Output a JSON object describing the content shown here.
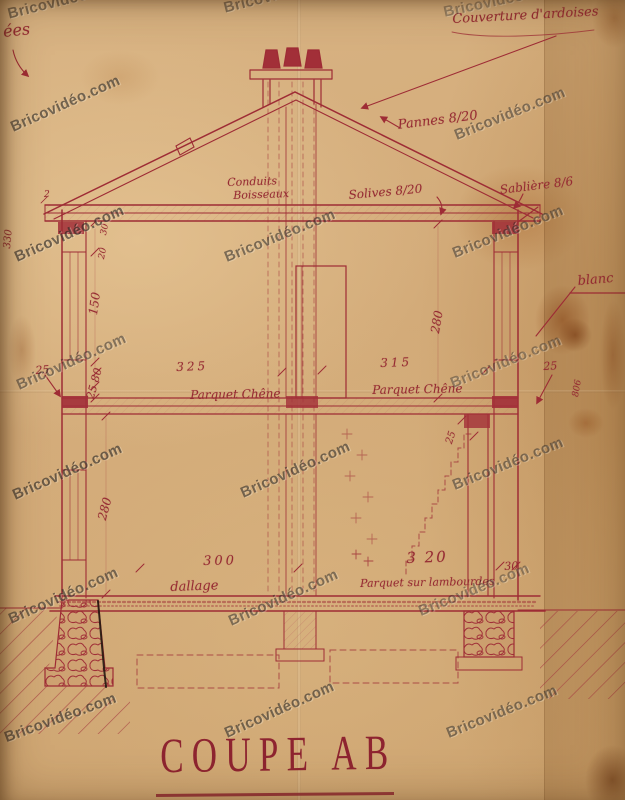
{
  "title": {
    "text": "COUPE AB"
  },
  "watermark": {
    "text": "Bricovidéo.com"
  },
  "annotations": [
    {
      "text": "ées"
    },
    {
      "text": "Couverture d'ardoises"
    },
    {
      "text": "Pannes 8/20"
    },
    {
      "text": "Conduits"
    },
    {
      "text": "Boisseaux"
    },
    {
      "text": "Solives 8/20"
    },
    {
      "text": "Sablière 8/6"
    },
    {
      "text": "blanc"
    },
    {
      "text": "330"
    },
    {
      "text": "30"
    },
    {
      "text": "20"
    },
    {
      "text": "150"
    },
    {
      "text": "25 80"
    },
    {
      "text": "25"
    },
    {
      "text": "325"
    },
    {
      "text": "Parquet Chêne"
    },
    {
      "text": "315"
    },
    {
      "text": "Parquet Chêne"
    },
    {
      "text": "25"
    },
    {
      "text": "280"
    },
    {
      "text": "280"
    },
    {
      "text": "25"
    },
    {
      "text": "300"
    },
    {
      "text": "dallage"
    },
    {
      "text": "3 20"
    },
    {
      "text": "Parquet sur lambourdes"
    },
    {
      "text": "30"
    },
    {
      "text": "806"
    },
    {
      "text": "2"
    }
  ],
  "colors": {
    "paper": "#d3ab79",
    "ink": "#9e2c35",
    "ink_dark": "#8e2430",
    "black_ink": "#241811",
    "watermark": "#282421"
  }
}
